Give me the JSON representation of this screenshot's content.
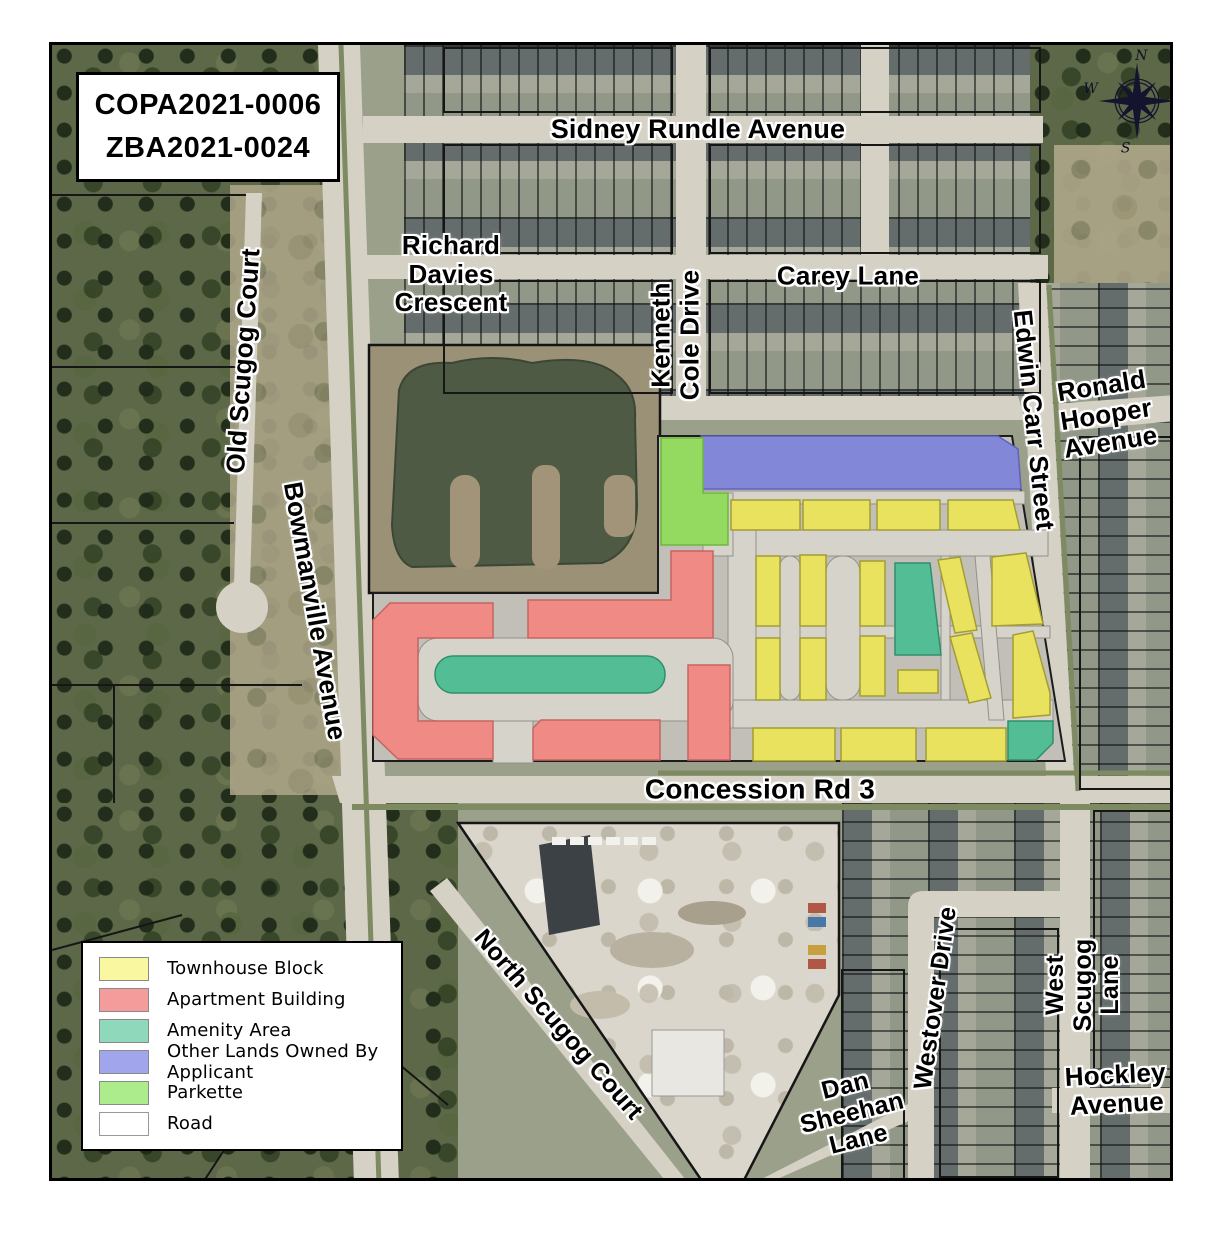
{
  "title_box": {
    "line1": "COPA2021-0006",
    "line2": "ZBA2021-0024"
  },
  "compass": {
    "north": "N",
    "east": "E",
    "south": "S",
    "west": "W"
  },
  "legend": {
    "items": [
      {
        "key": "townhouse",
        "label": "Townhouse Block"
      },
      {
        "key": "apartment",
        "label": "Apartment Building"
      },
      {
        "key": "amenity",
        "label": "Amenity Area"
      },
      {
        "key": "other_lands",
        "label": "Other Lands Owned By Applicant"
      },
      {
        "key": "parkette",
        "label": "Parkette"
      },
      {
        "key": "road",
        "label": "Road"
      }
    ]
  },
  "zone_colors": {
    "townhouse": "#e9e25e",
    "apartment": "#f08a85",
    "amenity": "#53bd96",
    "other_lands": "#8287d8",
    "parkette": "#95da60",
    "road": "#ffffff"
  },
  "legend_colors": {
    "townhouse": "#f9f7a0",
    "apartment": "#f49c9c",
    "amenity": "#8fd8bc",
    "other_lands": "#a0a5ec",
    "parkette": "#acec8c",
    "road": "#ffffff"
  },
  "streets": {
    "sidney_rundle": "Sidney Rundle Avenue",
    "richard_davies": "Richard\nDavies\nCrescent",
    "carey_lane": "Carey Lane",
    "kenneth_cole": "Kenneth\nCole Drive",
    "edwin_carr": "Edwin Carr Street",
    "ronald_hooper": "Ronald\nHooper\nAvenue",
    "old_scugog": "Old Scugog Court",
    "bowmanville": "Bowmanville Avenue",
    "concession": "Concession Rd 3",
    "north_scugog": "North Scugog Court",
    "dan_sheehan": "Dan\nSheehan\nLane",
    "westover": "Westover Drive",
    "west_scugog": "West\nScugog\nLane",
    "hockley": "Hockley\nAvenue"
  }
}
